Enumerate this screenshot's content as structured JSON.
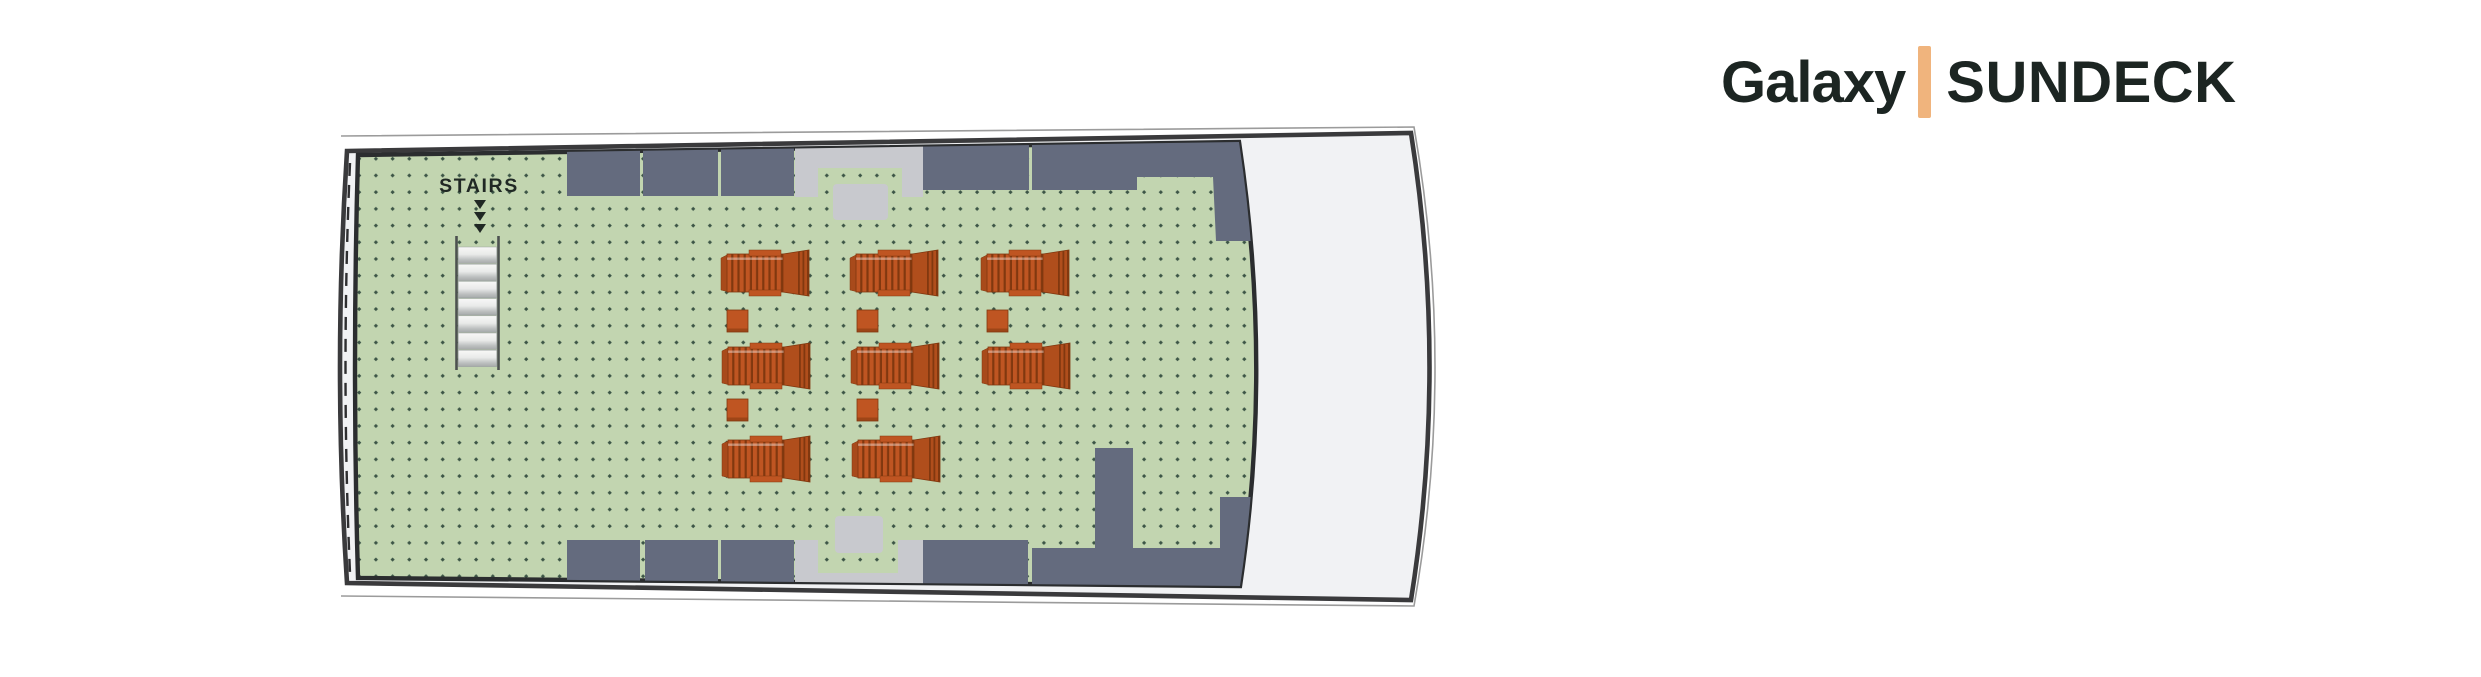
{
  "background": "#ffffff",
  "title": {
    "brand": "Galaxy",
    "deck": "SUNDECK",
    "separator_color": "#f0b47d",
    "text_color": "#1c2522"
  },
  "deck_plan": {
    "stairs_label": "STAIRS",
    "colors": {
      "deck_green": "#c2d5b0",
      "dot": "#3c5546",
      "structure_slate": "#646b7e",
      "structure_gray": "#c8c9ce",
      "hull_fill": "#f1f2f4",
      "hull_stroke": "#3a3a3c",
      "deck_border": "#2b2d2f",
      "outline_thin": "#9b9b9b",
      "dash_line": "#2e2e30",
      "lounger_main": "#bf5522",
      "lounger_dark": "#81380f",
      "lounger_back": "#b04e1c",
      "lounger_cap": "#a84a1b",
      "stair_rail": "#4c5150",
      "tread_edge": "#9aa0a0",
      "label_color": "#202824"
    },
    "hull": {
      "outline_thin_path": "M 341 136 L 1414 127 Q 1456 368 1414 606 L 341 596",
      "hull_path": "M 347 151 L 1411 133 Q 1448 368 1411 600 L 347 583 Q 333 367 347 151 Z",
      "bow_dash_path": "M 350 163 Q 341 367 350 573",
      "deck_path": "M 358 155 L 1239 142 Q 1273 368 1240 586 L 358 578 Q 352 367 358 155 Z"
    },
    "structures": {
      "slate": [
        [
          [
            567,
            140
          ],
          [
            640,
            140
          ],
          [
            640,
            196
          ],
          [
            567,
            196
          ]
        ],
        [
          [
            643,
            140
          ],
          [
            718,
            140
          ],
          [
            718,
            196
          ],
          [
            643,
            196
          ]
        ],
        [
          [
            721,
            140
          ],
          [
            794,
            140
          ],
          [
            794,
            196
          ],
          [
            721,
            196
          ]
        ],
        [
          [
            923,
            140
          ],
          [
            1029,
            139
          ],
          [
            1029,
            190
          ],
          [
            923,
            190
          ]
        ],
        [
          [
            1032,
            139
          ],
          [
            1262,
            137
          ],
          [
            1262,
            241
          ],
          [
            1216,
            241
          ],
          [
            1213,
            177
          ],
          [
            1137,
            177
          ],
          [
            1137,
            190
          ],
          [
            1032,
            190
          ]
        ],
        [
          [
            567,
            540
          ],
          [
            640,
            540
          ],
          [
            640,
            600
          ],
          [
            567,
            600
          ]
        ],
        [
          [
            645,
            540
          ],
          [
            718,
            540
          ],
          [
            718,
            601
          ],
          [
            645,
            600
          ]
        ],
        [
          [
            721,
            540
          ],
          [
            794,
            540
          ],
          [
            794,
            602
          ],
          [
            721,
            601
          ]
        ],
        [
          [
            923,
            540
          ],
          [
            1028,
            540
          ],
          [
            1028,
            604
          ],
          [
            923,
            603
          ]
        ],
        [
          [
            1032,
            548
          ],
          [
            1095,
            548
          ],
          [
            1095,
            448
          ],
          [
            1133,
            448
          ],
          [
            1133,
            548
          ],
          [
            1220,
            548
          ],
          [
            1220,
            497
          ],
          [
            1262,
            497
          ],
          [
            1262,
            608
          ],
          [
            1032,
            606
          ]
        ]
      ],
      "gray": [
        [
          [
            795,
            140
          ],
          [
            923,
            140
          ],
          [
            923,
            197
          ],
          [
            902,
            197
          ],
          [
            902,
            168
          ],
          [
            818,
            168
          ],
          [
            818,
            197
          ],
          [
            795,
            197
          ]
        ],
        [
          [
            795,
            540
          ],
          [
            818,
            540
          ],
          [
            818,
            573
          ],
          [
            898,
            573
          ],
          [
            898,
            540
          ],
          [
            923,
            540
          ],
          [
            923,
            603
          ],
          [
            795,
            601
          ]
        ]
      ],
      "gray_boxes": [
        {
          "x": 833,
          "y": 184,
          "w": 55,
          "h": 36,
          "r": 4
        },
        {
          "x": 835,
          "y": 516,
          "w": 48,
          "h": 37,
          "r": 4
        }
      ]
    },
    "stairs": {
      "label_x": 479,
      "label_y": 192,
      "arrows": {
        "cx": 480,
        "tops": [
          200,
          212,
          224
        ],
        "w": 12,
        "h": 9
      },
      "rails": {
        "x1": 456.5,
        "x2": 498.5,
        "y1": 236,
        "y2": 370,
        "width": 2.6
      },
      "treads": {
        "x": 458.3,
        "w": 38.4,
        "y": 247,
        "h": 16.4,
        "step": 17.2,
        "count": 7
      }
    },
    "furniture": {
      "lounger_count": 8,
      "table_count": 5,
      "lounger_size": {
        "w": 88,
        "h": 46
      },
      "table_size": {
        "w": 21,
        "h": 22
      },
      "loungers": [
        [
          721,
          250
        ],
        [
          850,
          250
        ],
        [
          981,
          250
        ],
        [
          722,
          343
        ],
        [
          851,
          343
        ],
        [
          982,
          343
        ],
        [
          722,
          436
        ],
        [
          852,
          436
        ]
      ],
      "tables": [
        [
          727,
          310
        ],
        [
          857,
          310
        ],
        [
          987,
          310
        ],
        [
          727,
          399
        ],
        [
          857,
          399
        ]
      ]
    }
  }
}
